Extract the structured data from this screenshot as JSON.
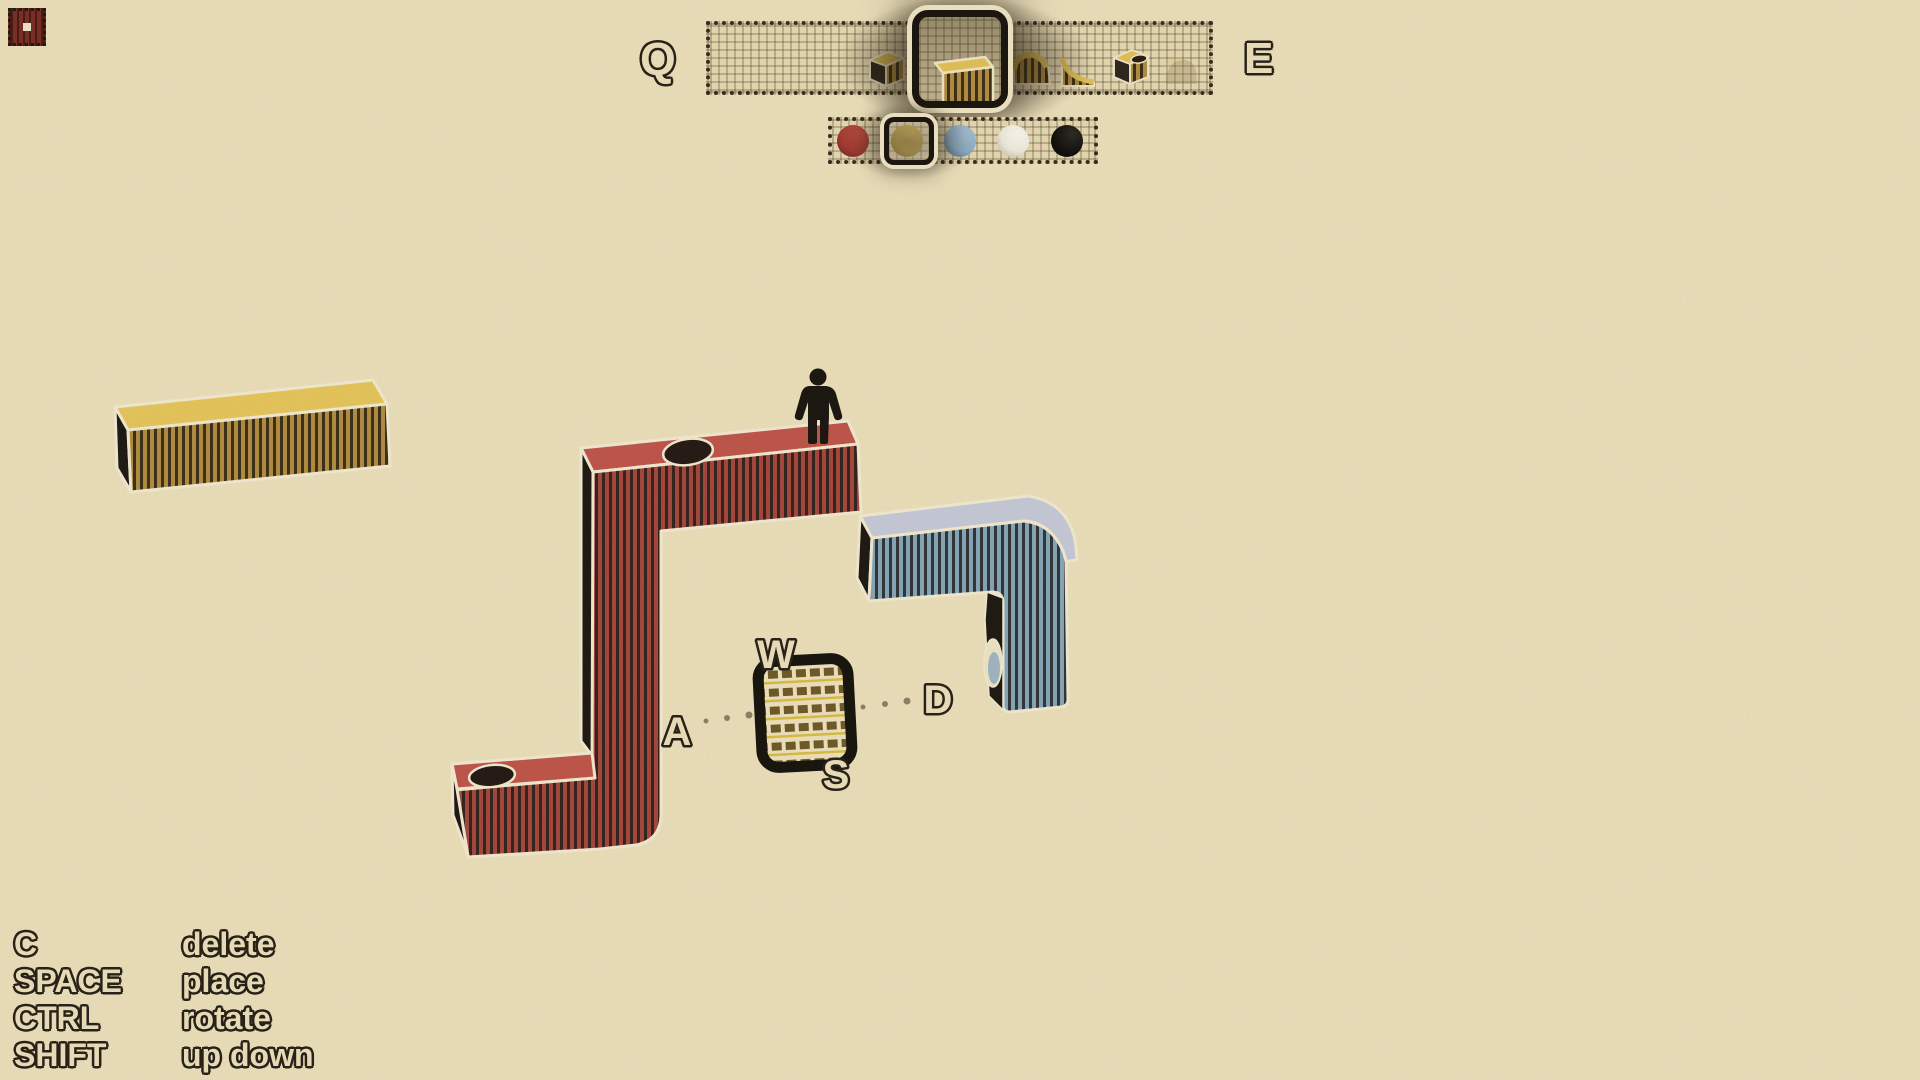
{
  "toolbar": {
    "cycle_left_key": "Q",
    "cycle_right_key": "E",
    "items": [
      {
        "name": "cube",
        "selected": false
      },
      {
        "name": "tall-column",
        "selected": true
      },
      {
        "name": "ramp-convex",
        "selected": false
      },
      {
        "name": "ramp-concave",
        "selected": false
      },
      {
        "name": "cube-with-hole",
        "selected": false
      },
      {
        "name": "ghost-shape",
        "selected": false
      }
    ]
  },
  "palette": {
    "selected_index": 1,
    "colors": [
      {
        "name": "red",
        "hex": "#A93A32"
      },
      {
        "name": "yellow",
        "hex": "#BD952C"
      },
      {
        "name": "blue",
        "hex": "#8FB2CD"
      },
      {
        "name": "white",
        "hex": "#EFEBDF"
      },
      {
        "name": "black",
        "hex": "#100F0D"
      }
    ]
  },
  "compass": {
    "up": "W",
    "left": "A",
    "down": "S",
    "right": "D"
  },
  "shortcuts": [
    {
      "key": "C",
      "action": "delete"
    },
    {
      "key": "SPACE",
      "action": "place"
    },
    {
      "key": "CTRL",
      "action": "rotate"
    },
    {
      "key": "SHIFT",
      "action": "up down"
    }
  ],
  "scene": {
    "paper_color": "#EDE1BC",
    "outline_color": "#F3EBD2",
    "blocks": [
      {
        "name": "yellow-bar",
        "top": "#E7C65A",
        "front": "#B18C41"
      },
      {
        "name": "red-tower",
        "top": "#C05449",
        "front": "#A4453B",
        "holes": 2
      },
      {
        "name": "blue-arch",
        "top": "#C6CAD9",
        "front": "#84A6B9"
      },
      {
        "name": "cursor-preview-block",
        "stripe": "#6E5826",
        "accent": "#D9BD44"
      }
    ],
    "character": {
      "color": "#17130E"
    }
  },
  "minimap": {
    "fill": "#7A2B23"
  }
}
